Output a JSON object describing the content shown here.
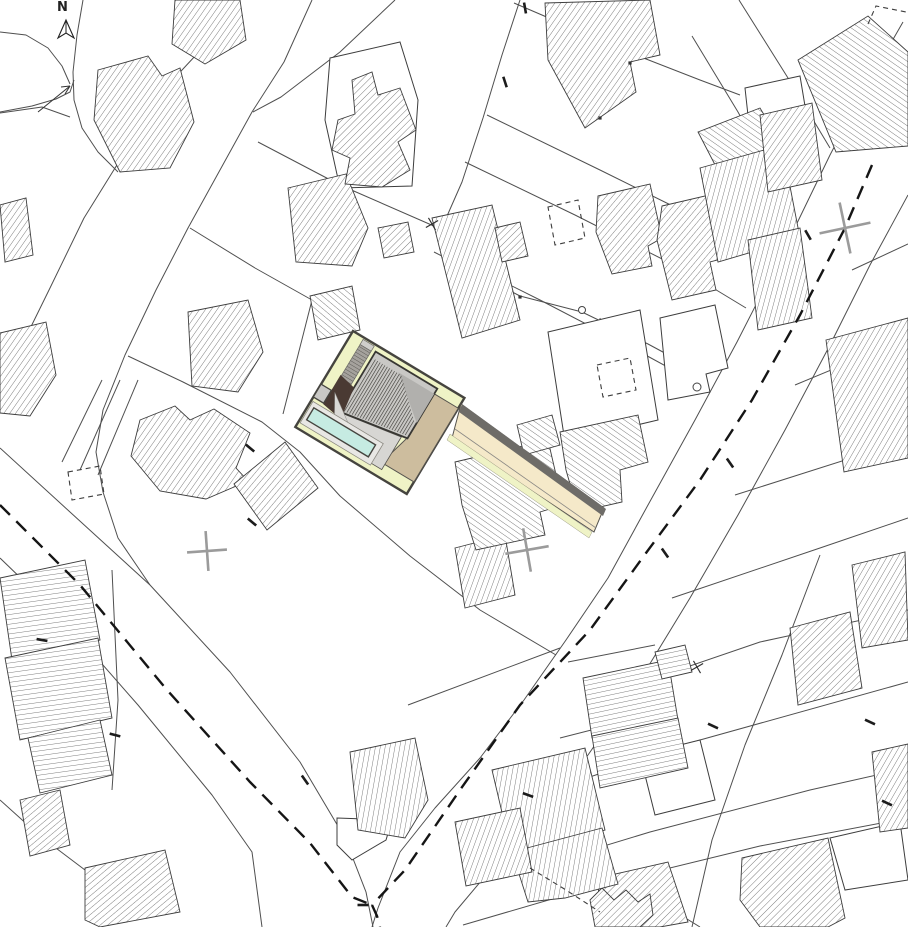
{
  "meta": {
    "width": 908,
    "height": 927,
    "background": "#ffffff",
    "drawing_type": "architectural-site-plan"
  },
  "labels": {
    "north": "N"
  },
  "colors": {
    "line": "#4f4f4f",
    "building_outline": "#3d3d3d",
    "hatch": "#474747",
    "dashed_boundary": "#151515",
    "survey_cross": "#9b9b9b",
    "site_yellow": "#eff3c6",
    "driveway_cream": "#f5e9c9",
    "driveway_edge_dark": "#6e6c68",
    "tan": "#cdbd9e",
    "roof_gray": "#c9c8c5",
    "roof_wedge": "#b1b0ad",
    "roof_stripe": "#35342f",
    "terrace_gray": "#d7d6d3",
    "brown": "#4a3a33",
    "wedge_light": "#dad9d6",
    "pool_aqua": "#c6ebe2",
    "pool_deck": "#e8e7e4",
    "boardwalk": "#a5a29d",
    "boardwalk_cap": "#cfcecb",
    "site_outline": "#45443f"
  },
  "parcel_lines": [
    {
      "p": "903,22 865,88 830,155 785,248 737,342 695,420 648,505 608,578 566,640 524,700 480,758 435,808 400,852 378,908 372,927"
    },
    {
      "p": "908,195 870,265 830,345 785,430 738,515 690,598 640,680 588,755 538,818 492,868 455,912 446,927"
    },
    {
      "p": "0,448 70,512 150,585 230,672 300,762 345,838 366,892 373,927"
    },
    {
      "p": "0,558 60,616 138,705 212,795 252,852 262,927"
    },
    {
      "p": "233,0 196,55 156,98 120,160 84,218 50,288 22,345 0,380"
    },
    {
      "p": "312,0 284,62 252,112 220,170 188,228 156,290 125,355 103,410 96,452 103,492 118,538 150,585"
    },
    {
      "p": "83,0 77,35 73,72 74,100 82,128 98,152 118,172"
    },
    {
      "p": "0,112 32,106 56,99 70,92 74,80"
    },
    {
      "p": "0,32 26,35 48,48 62,66 70,84"
    },
    {
      "p": "0,113 42,107 70,117"
    },
    {
      "p": "395,0 340,52 281,97 253,112"
    },
    {
      "p": "258,142 340,185 443,230 470,242"
    },
    {
      "p": "520,0 502,55 483,118 462,182 440,232"
    },
    {
      "p": "190,228 255,268 312,300 352,332"
    },
    {
      "p": "128,356 183,382 262,422 300,452 340,496 410,556 480,610 556,655"
    },
    {
      "p": "514,3 628,52 700,80 740,95"
    },
    {
      "p": "692,36 738,112 775,180 792,232"
    },
    {
      "p": "739,0 788,78 830,148"
    },
    {
      "p": "487,115 600,170 705,222 770,260"
    },
    {
      "p": "465,162 575,215 680,268 746,308"
    },
    {
      "p": "440,250 540,300 640,352 706,388"
    },
    {
      "p": "434,252 520,296 582,312 648,344 700,372"
    },
    {
      "p": "852,270 908,244"
    },
    {
      "p": "795,385 908,338"
    },
    {
      "p": "735,495 908,440"
    },
    {
      "p": "672,598 820,548 908,518"
    },
    {
      "p": "608,694 760,642 908,610"
    },
    {
      "p": "545,792 700,740 908,682"
    },
    {
      "p": "492,880 650,832 810,790 908,768"
    },
    {
      "p": "463,925 600,885 760,846 908,818"
    },
    {
      "p": "530,842 640,890 700,927"
    },
    {
      "p": "820,555 782,655 745,745 712,840 692,927"
    },
    {
      "p": "568,662 655,645"
    },
    {
      "p": "560,738 662,712"
    },
    {
      "p": "408,705 560,648"
    },
    {
      "p": "112,570 118,700 112,790"
    },
    {
      "p": "138,380 98,475"
    },
    {
      "p": "120,380 80,470"
    },
    {
      "p": "102,380 62,462"
    },
    {
      "p": "0,800 40,836 85,870"
    },
    {
      "p": "600,318 615,432"
    },
    {
      "p": "312,300 283,414"
    }
  ],
  "buildings_white": [
    {
      "p": "330,58 400,42 418,100 412,186 340,188 325,120"
    },
    {
      "p": "548,332 640,310 658,420 565,442"
    },
    {
      "p": "660,318 715,305 728,368 706,374 710,392 668,400"
    },
    {
      "p": "745,88 800,76 812,148 780,162 752,152"
    },
    {
      "p": "640,755 700,740 715,800 655,815"
    },
    {
      "p": "830,838 900,822 908,880 845,890"
    },
    {
      "p": "337,818 392,820 386,840 352,860 337,845"
    }
  ],
  "buildings_hatched": [
    {
      "p": "175,0 240,0 246,40 205,64 172,44",
      "a": -55
    },
    {
      "p": "98,70 148,56 162,76 180,68 194,122 170,168 120,172 94,120",
      "a": -55
    },
    {
      "p": "288,188 346,174 368,228 352,266 296,262",
      "a": -55
    },
    {
      "p": "352,80 372,72 378,95 400,88 416,130 398,142 410,170 382,187 345,184 350,158 332,150 338,120 355,114",
      "a": -45
    },
    {
      "p": "0,205 26,198 33,255 5,262",
      "a": -55
    },
    {
      "p": "188,312 248,300 263,352 238,392 192,386",
      "a": -55
    },
    {
      "p": "0,333 46,322 56,375 30,416 0,413",
      "a": -55
    },
    {
      "p": "140,420 175,406 190,420 214,409 250,433 236,468 248,481 206,499 160,491 131,456",
      "a": -55
    },
    {
      "p": "285,442 318,488 267,530 234,484",
      "a": -50
    },
    {
      "p": "545,3 650,0 660,55 630,62 636,92 585,128 548,60",
      "a": -55
    },
    {
      "p": "432,218 492,205 520,320 462,338",
      "a": -70
    },
    {
      "p": "378,228 408,222 414,252 384,258",
      "a": -45
    },
    {
      "p": "495,228 520,222 528,256 502,262",
      "a": -45
    },
    {
      "p": "598,196 650,184 662,238 648,246 652,266 612,274 596,232",
      "a": -50
    },
    {
      "p": "662,206 722,192 736,255 710,262 716,290 672,300 657,240",
      "a": -50
    },
    {
      "p": "698,132 760,108 790,158 726,186",
      "a": 35
    },
    {
      "p": "700,168 782,145 800,238 718,262",
      "a": -75
    },
    {
      "p": "798,60 868,16 908,52 908,146 836,152",
      "a": 35
    },
    {
      "p": "760,115 812,103 822,180 768,192",
      "a": -55
    },
    {
      "p": "748,240 800,228 812,318 758,330",
      "a": -75
    },
    {
      "p": "826,340 908,318 908,458 844,472",
      "a": -60
    },
    {
      "p": "852,565 905,552 908,640 862,648",
      "a": -60
    },
    {
      "p": "790,628 850,612 862,688 798,705",
      "a": -45
    },
    {
      "p": "742,858 828,838 845,918 828,927 760,927 740,900",
      "a": -45
    },
    {
      "p": "598,878 668,862 688,922 660,927 600,927",
      "a": -45
    },
    {
      "p": "590,900 602,888 614,900 626,890 638,902 650,894 653,915 640,927 595,927",
      "a": -45
    },
    {
      "p": "492,770 585,748 605,830 512,855",
      "a": -80
    },
    {
      "p": "512,852 602,828 618,884 565,898 528,902",
      "a": -80
    },
    {
      "p": "350,752 415,738 428,800 405,838 358,830",
      "a": -80
    },
    {
      "p": "583,678 668,660 678,720 592,738",
      "a": -12
    },
    {
      "p": "592,736 678,718 688,768 600,788",
      "a": -12
    },
    {
      "p": "655,652 685,645 692,672 662,679",
      "a": -12
    },
    {
      "p": "455,548 505,535 515,595 465,608",
      "a": -70
    },
    {
      "p": "0,578 85,560 100,640 12,660",
      "a": -8
    },
    {
      "p": "5,658 98,638 112,718 20,740",
      "a": -8
    },
    {
      "p": "28,738 100,720 112,775 40,793",
      "a": -8
    },
    {
      "p": "20,800 60,790 70,845 30,856",
      "a": -40
    },
    {
      "p": "85,868 165,850 180,912 100,927 85,920",
      "a": -40
    },
    {
      "p": "455,462 548,440 563,505 540,512 545,535 476,550 462,505",
      "a": 35
    },
    {
      "p": "517,425 552,415 560,445 524,455",
      "a": 35
    },
    {
      "p": "560,432 638,415 648,462 620,470 622,502 578,512 566,470",
      "a": 35
    },
    {
      "p": "310,296 352,286 360,330 318,340",
      "a": 40
    },
    {
      "p": "455,822 520,808 532,872 466,886",
      "a": -70
    },
    {
      "p": "872,752 908,744 908,828 880,832",
      "a": -60
    }
  ],
  "dashed_boundaries": [
    {
      "p": "872,165 845,228 800,315 752,400 700,480 646,553 590,630 520,705 460,790 405,870 372,905"
    },
    {
      "p": "0,505 80,585 167,690 250,782 310,843 352,897 372,905"
    },
    {
      "p": "372,905 377,916 380,927"
    }
  ],
  "dashed_shapes": [
    {
      "p": "548,207 578,200 585,238 555,245",
      "closed": true
    },
    {
      "p": "597,365 630,358 636,390 603,397",
      "closed": true
    },
    {
      "p": "68,472 100,466 104,494 72,500",
      "closed": true
    },
    {
      "p": "868,24 876,6 906,12",
      "closed": false
    },
    {
      "p": "530,868 566,890 600,912",
      "closed": false
    }
  ],
  "survey_crosses": [
    {
      "x": 845,
      "y": 228,
      "rot": -12,
      "arm": 26
    },
    {
      "x": 207,
      "y": 551,
      "rot": -4,
      "arm": 20
    },
    {
      "x": 527,
      "y": 550,
      "rot": -10,
      "arm": 22
    }
  ],
  "x_marks": [
    {
      "x": 432,
      "y": 224
    },
    {
      "x": 697,
      "y": 667
    }
  ],
  "circle_markers": [
    {
      "x": 582,
      "y": 310,
      "r": 3.5
    },
    {
      "x": 697,
      "y": 387,
      "r": 4
    }
  ],
  "point_markers": [
    {
      "x": 630,
      "y": 63
    },
    {
      "x": 600,
      "y": 118
    },
    {
      "x": 520,
      "y": 297
    }
  ],
  "edge_ticks": [
    {
      "x": 525,
      "y": 8,
      "rot": 80
    },
    {
      "x": 505,
      "y": 82,
      "rot": 72
    },
    {
      "x": 808,
      "y": 235,
      "rot": 60
    },
    {
      "x": 730,
      "y": 463,
      "rot": 55
    },
    {
      "x": 665,
      "y": 553,
      "rot": 55
    },
    {
      "x": 870,
      "y": 722,
      "rot": 25
    },
    {
      "x": 887,
      "y": 803,
      "rot": 25
    },
    {
      "x": 528,
      "y": 795,
      "rot": 20
    },
    {
      "x": 713,
      "y": 726,
      "rot": 25
    },
    {
      "x": 42,
      "y": 640,
      "rot": 10
    },
    {
      "x": 115,
      "y": 735,
      "rot": 15
    },
    {
      "x": 305,
      "y": 780,
      "rot": 55
    },
    {
      "x": 252,
      "y": 522,
      "rot": 40
    },
    {
      "x": 250,
      "y": 448,
      "rot": 40
    },
    {
      "x": 363,
      "y": 905,
      "rot": 0
    }
  ],
  "north_arrow": {
    "cx": 66,
    "tip_y": 20,
    "base_y": 38,
    "half_w": 8,
    "notch_y": 33
  },
  "annotation_arrow": {
    "shaft": "38,112 70,86",
    "head1": "70,86 61,87",
    "head2": "70,86 65,94"
  },
  "site": {
    "transform": {
      "tx": 353,
      "ty": 331,
      "rot": 31
    },
    "boundary": {
      "x": 0,
      "y": 0,
      "w": 130,
      "h": 112
    },
    "boardwalk_cap": {
      "x": 13,
      "y": 2,
      "w": 13,
      "h": 6
    },
    "boardwalk": {
      "x": 13,
      "y": 8,
      "w": 13,
      "h": 42
    },
    "roof_base": "30,6 102,6 102,64 30,76",
    "roof_wedge": "60,12 102,12 102,46",
    "roof_stripes_clip": "32,13 64,13 100,47 100,62 32,74",
    "tan": "102,12 130,12 130,98 72,98 72,84 96,84 102,62",
    "terrace": "34,76 96,66 96,104 34,104",
    "brown": "12,44 30,48 34,76 36,82 12,78",
    "wedge": "16,62 44,82 30,86",
    "pool_deck": {
      "x": 2,
      "y": 81,
      "w": 82,
      "h": 25
    },
    "pool": {
      "x": 6,
      "y": 86,
      "w": 72,
      "h": 14
    },
    "shed": {
      "x": 0,
      "y": 62,
      "w": 12,
      "h": 15
    }
  },
  "driveway": {
    "main": "461,404 604,508 594,532 452,438",
    "dark_edge": "462,404 606,509 603,516 459,412",
    "green_strip": "450,434 592,532 589,538 447,440",
    "inner_line": "455,429 596,528"
  }
}
